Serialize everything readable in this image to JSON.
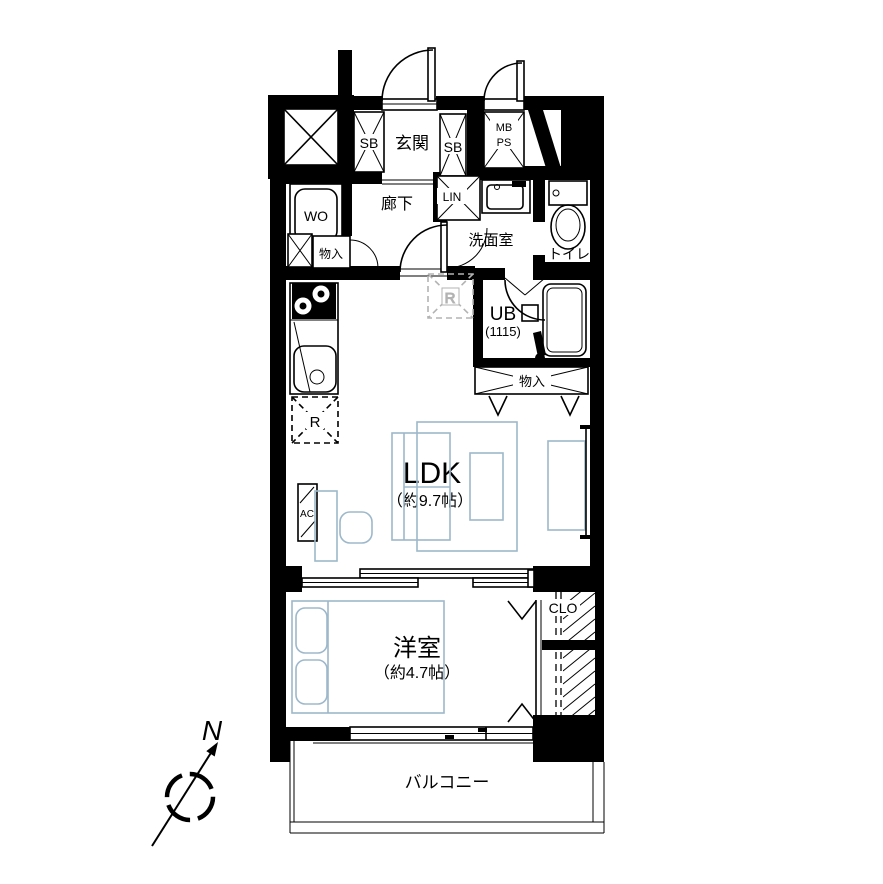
{
  "plan": {
    "rooms": {
      "entrance": {
        "label": "玄関"
      },
      "corridor": {
        "label": "廊下"
      },
      "washroom": {
        "label": "洗面室"
      },
      "toilet": {
        "label": "トイレ"
      },
      "unit_bath": {
        "label": "UB",
        "size": "(1115)"
      },
      "ldk": {
        "label": "LDK",
        "size": "（約9.7帖）"
      },
      "western_room": {
        "label": "洋室",
        "size": "（約4.7帖）"
      },
      "balcony": {
        "label": "バルコニー"
      },
      "closet": {
        "label": "CLO"
      },
      "hall_storage": {
        "label": "物入"
      },
      "ldk_storage": {
        "label": "物入"
      }
    },
    "fixtures": {
      "shoe_box_left": {
        "label": "SB"
      },
      "shoe_box_right": {
        "label": "SB"
      },
      "meter_box": {
        "label": "MB"
      },
      "pipe_space": {
        "label": "PS"
      },
      "linen_cabinet": {
        "label": "LIN"
      },
      "washer_space": {
        "label": "WO"
      },
      "air_conditioner": {
        "label": "AC"
      },
      "refrigerator_kitchen": {
        "label": "R"
      },
      "refrigerator_wall": {
        "label": "R"
      }
    },
    "compass": {
      "north_label": "N"
    },
    "colors": {
      "wall": "#000000",
      "furniture_outline": "#9db8ca",
      "dashed_gray": "#b3b3b3"
    }
  }
}
